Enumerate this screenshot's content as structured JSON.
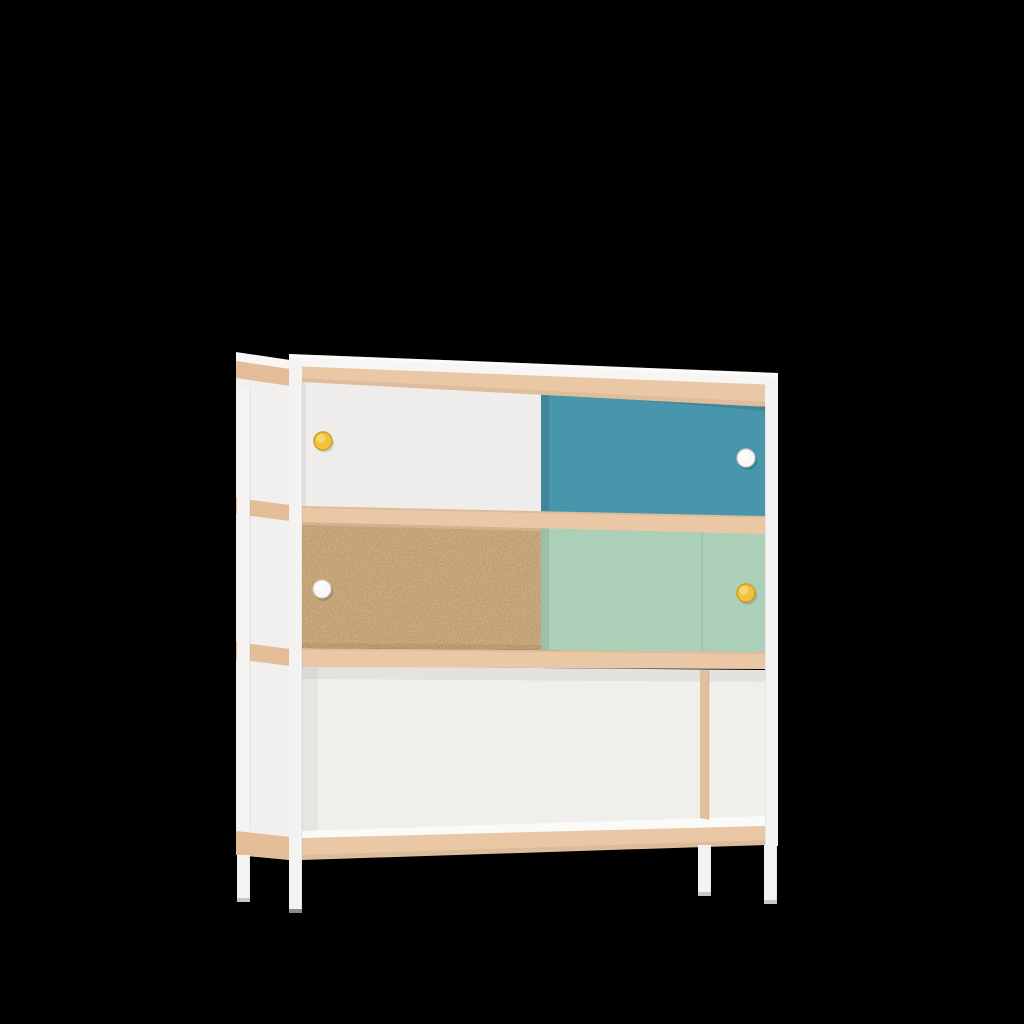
{
  "scene": {
    "kind": "product-render",
    "subject": "sideboard cabinet with sliding doors on four legs",
    "background": "plain black"
  },
  "furniture": {
    "frame": "white frame and legs",
    "edges": "light beech wood shelf edges",
    "top_row": {
      "left_door": "white sliding door",
      "left_knob": "yellow round knob",
      "right_door": "teal blue sliding door",
      "right_knob": "white round knob"
    },
    "middle_row": {
      "left_door": "natural MDF sliding door",
      "left_knob": "white round knob",
      "right_door": "mint green sliding door",
      "right_knob": "yellow round knob"
    },
    "bottom_row": "open white shelf compartment with vertical divider near the right side",
    "legs": "4 slim white legs with gray caps"
  },
  "colors": {
    "background": "#000000",
    "frame_white": "#f4f3f1",
    "top_white": "#f7f6f4",
    "side_white": "#f1f0ee",
    "wood_edge": "#ebc8a5",
    "wood_edge_dark": "#e2bd98",
    "door_white": "#efedeb",
    "door_teal": "#4896ac",
    "door_mdf": "#b8935f",
    "door_mint": "#accfb8",
    "interior_white": "#f1efec",
    "shelf_surface": "#fafaf8",
    "divider_wood": "#e3c09c",
    "knob_yellow": "#f2c338",
    "knob_yellow_rim": "#cf9c1d",
    "knob_white": "#f9f8f7",
    "knob_white_rim": "#cfccc9",
    "leg_cap": "#c9c7c4",
    "leg_cap_dark": "#8e8c89"
  }
}
